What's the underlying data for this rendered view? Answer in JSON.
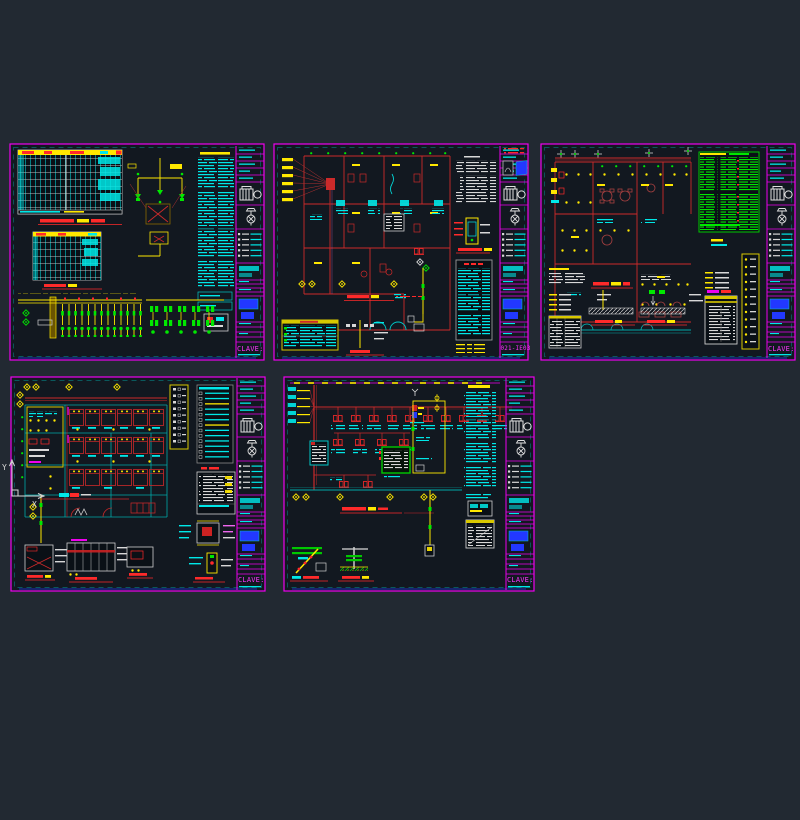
{
  "viewport": {
    "background": "#222932",
    "sheet_background": "#121820"
  },
  "palette": {
    "border_magenta": "#ee00ee",
    "cyan": "#00e8e8",
    "yellow": "#ffe800",
    "green": "#00e800",
    "red": "#ff2a2a",
    "wall_red": "#cc2a2a",
    "white": "#d8d8d8",
    "blue": "#2238ff",
    "teal": "#00a8a8",
    "key_magenta": "#ff35ff"
  },
  "ucs": {
    "x_label": "X",
    "y_label": "Y"
  },
  "sheets": [
    {
      "id": "sheet-1",
      "title_block_key": "CLAVE:"
    },
    {
      "id": "sheet-2",
      "title_block_key": "021-IE03"
    },
    {
      "id": "sheet-3",
      "title_block_key": "CLAVE:"
    },
    {
      "id": "sheet-4",
      "title_block_key": "CLAVE:"
    },
    {
      "id": "sheet-5",
      "title_block_key": "CLAVE:"
    }
  ]
}
